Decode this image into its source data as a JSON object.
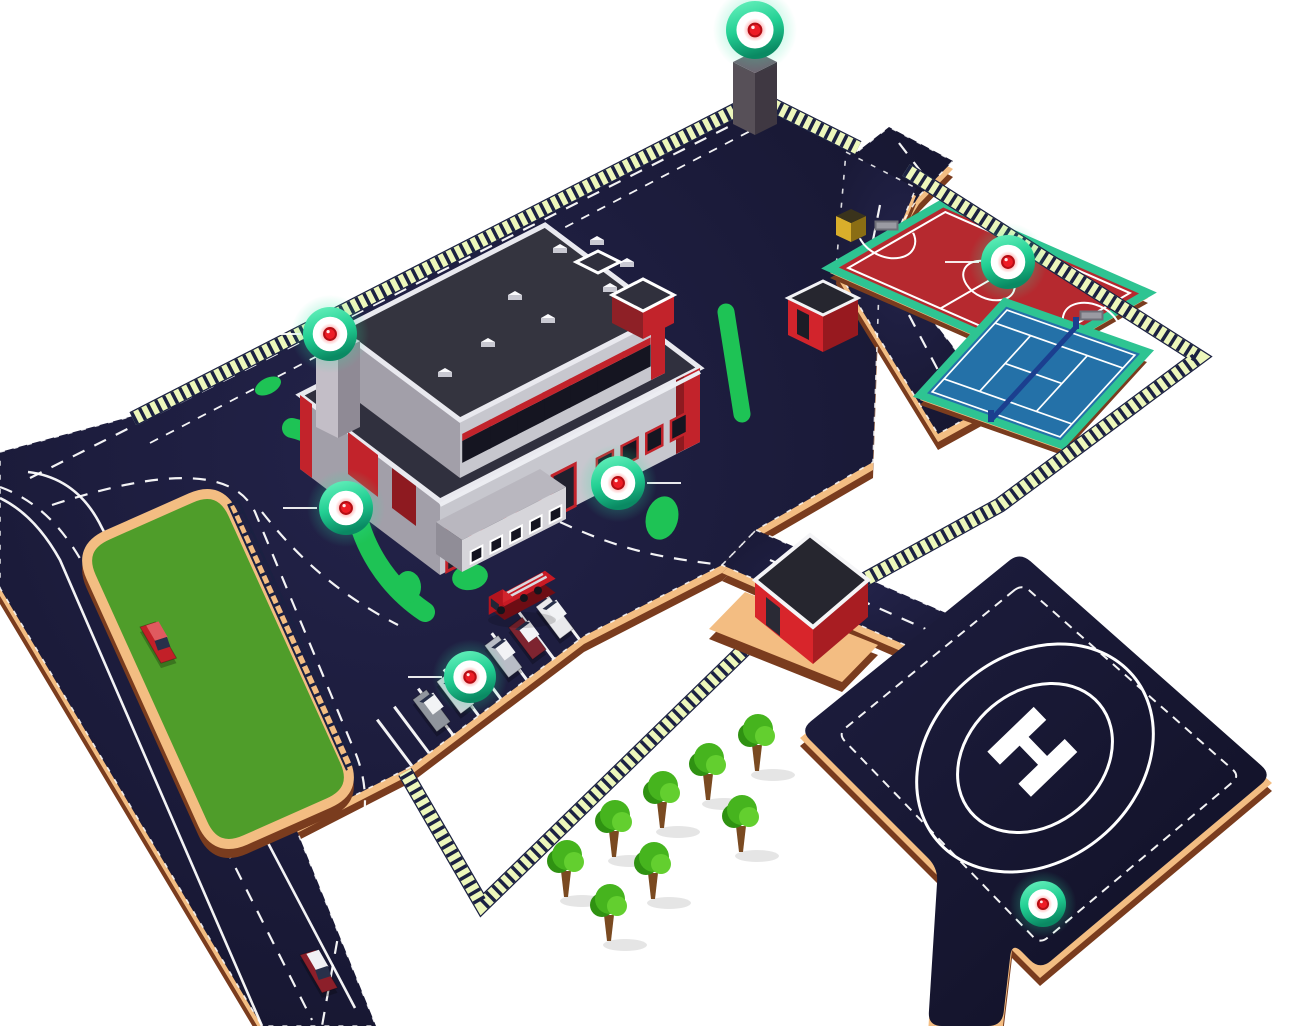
{
  "scene": {
    "width": 1292,
    "height": 1026,
    "background": "#ffffff",
    "description": "Isometric map of a fire-station campus with helipad, sports courts, parking, green field and round security markers"
  },
  "colors": {
    "pavement": "#1b1b3a",
    "pavement_deep": "#13132a",
    "curb_tan": "#f3bd82",
    "curb_brown": "#7a3c1e",
    "fence_light": "#edf7bb",
    "fence_dark": "#1b2142",
    "grass_field": "#4f9d2a",
    "hedge_green": "#1ec355",
    "building_gray_light": "#c7c7ce",
    "building_gray_mid": "#a29fa9",
    "building_gray_dark": "#908d97",
    "roof_dark": "#30303e",
    "accent_red": "#c2232b",
    "accent_red_dark": "#8e1a20",
    "court_red": "#b6292f",
    "court_blue": "#2471a8",
    "court_teal": "#2ec492",
    "net_blue": "#1b3f8f",
    "marker_teal_light": "#5ff0b8",
    "marker_teal_dark": "#0a8a63",
    "marker_red": "#ee1c25",
    "white": "#ffffff"
  },
  "helipad": {
    "symbol": "H",
    "shape": [
      [
        1020,
        552
      ],
      [
        1272,
        775
      ],
      [
        1040,
        970
      ],
      [
        1012,
        942
      ],
      [
        1002,
        1026
      ],
      [
        928,
        1026
      ],
      [
        938,
        868
      ],
      [
        800,
        730
      ]
    ],
    "dash_inset": [
      [
        1022,
        584
      ],
      [
        1240,
        776
      ],
      [
        1040,
        944
      ],
      [
        838,
        734
      ]
    ],
    "circle_center": [
      1035,
      758
    ],
    "outer_circle": [
      128,
      103
    ],
    "inner_circle": [
      84,
      67
    ]
  },
  "pavement_main": [
    [
      0,
      452
    ],
    [
      133,
      416
    ],
    [
      752,
      100
    ],
    [
      771,
      109
    ],
    [
      857,
      152
    ],
    [
      889,
      127
    ],
    [
      953,
      161
    ],
    [
      919,
      196
    ],
    [
      880,
      258
    ],
    [
      873,
      462
    ],
    [
      756,
      530
    ],
    [
      722,
      565
    ],
    [
      584,
      636
    ],
    [
      412,
      766
    ],
    [
      295,
      826
    ],
    [
      376,
      1026
    ],
    [
      262,
      1026
    ],
    [
      0,
      588
    ]
  ],
  "guard_road": [
    [
      756,
      530
    ],
    [
      1024,
      647
    ],
    [
      990,
      682
    ],
    [
      722,
      565
    ]
  ],
  "courts_road": [
    [
      846,
      152
    ],
    [
      916,
      188
    ],
    [
      886,
      260
    ],
    [
      996,
      402
    ],
    [
      938,
      434
    ],
    [
      836,
      268
    ]
  ],
  "field": {
    "corners": [
      [
        78,
        548
      ],
      [
        220,
        485
      ],
      [
        358,
        790
      ],
      [
        216,
        853
      ]
    ],
    "ladder": [
      [
        233,
        502
      ],
      [
        352,
        768
      ]
    ]
  },
  "fences": [
    {
      "name": "north-fence",
      "pts": [
        [
          133,
          419
        ],
        [
          752,
          102
        ]
      ]
    },
    {
      "name": "gate-fence",
      "pts": [
        [
          770,
          104
        ],
        [
          858,
          148
        ]
      ]
    },
    {
      "name": "east-fence",
      "pts": [
        [
          906,
          170
        ],
        [
          1199,
          357
        ],
        [
          1000,
          505
        ],
        [
          752,
          642
        ],
        [
          482,
          905
        ],
        [
          405,
          772
        ]
      ]
    }
  ],
  "courts": {
    "futsal": {
      "N": [
        943,
        203
      ],
      "E": [
        1148,
        293
      ],
      "W": [
        830,
        268
      ]
    },
    "tennis": {
      "N": [
        1005,
        302
      ],
      "E": [
        1147,
        352
      ],
      "W": [
        920,
        395
      ]
    }
  },
  "parking": {
    "edge_a": [
      583,
      637
    ],
    "edge_b": [
      412,
      766
    ],
    "stall_ts": [
      0.02,
      0.17,
      0.33,
      0.48,
      0.61,
      0.76,
      0.9,
      1.0
    ],
    "stall_len": 58
  },
  "markers": [
    {
      "name": "perimeter-tower",
      "x": 755,
      "y": 30,
      "r": 29,
      "leader": 0
    },
    {
      "name": "building-chimney",
      "x": 330,
      "y": 334,
      "r": 27,
      "leader": -1
    },
    {
      "name": "building-west",
      "x": 346,
      "y": 508,
      "r": 27,
      "leader": -1
    },
    {
      "name": "building-front",
      "x": 618,
      "y": 483,
      "r": 27,
      "leader": 1
    },
    {
      "name": "sports-courts",
      "x": 1008,
      "y": 262,
      "r": 27,
      "leader": -1
    },
    {
      "name": "parking",
      "x": 470,
      "y": 677,
      "r": 26,
      "leader": -1
    },
    {
      "name": "helipad",
      "x": 1043,
      "y": 904,
      "r": 23,
      "leader": 0
    }
  ],
  "trees": [
    [
      757,
      771
    ],
    [
      708,
      800
    ],
    [
      662,
      828
    ],
    [
      614,
      857
    ],
    [
      741,
      852
    ],
    [
      653,
      899
    ],
    [
      566,
      897
    ],
    [
      609,
      941
    ]
  ],
  "vehicles": {
    "fire_truck": {
      "color": "#c81a24",
      "x": 494,
      "y": 612
    },
    "road_cars": [
      {
        "color": "#c22028",
        "x": 140,
        "y": 630
      },
      {
        "color": "#8c1f2a",
        "x": 300,
        "y": 958
      }
    ],
    "parked_cars": [
      {
        "color": "#e9e9ec",
        "slot": 0.1
      },
      {
        "color": "#7e2430",
        "slot": 0.26
      },
      {
        "color": "#b9bdc6",
        "slot": 0.4
      },
      {
        "color": "#cfd2d8",
        "slot": 0.68
      },
      {
        "color": "#90959d",
        "slot": 0.82
      }
    ]
  }
}
